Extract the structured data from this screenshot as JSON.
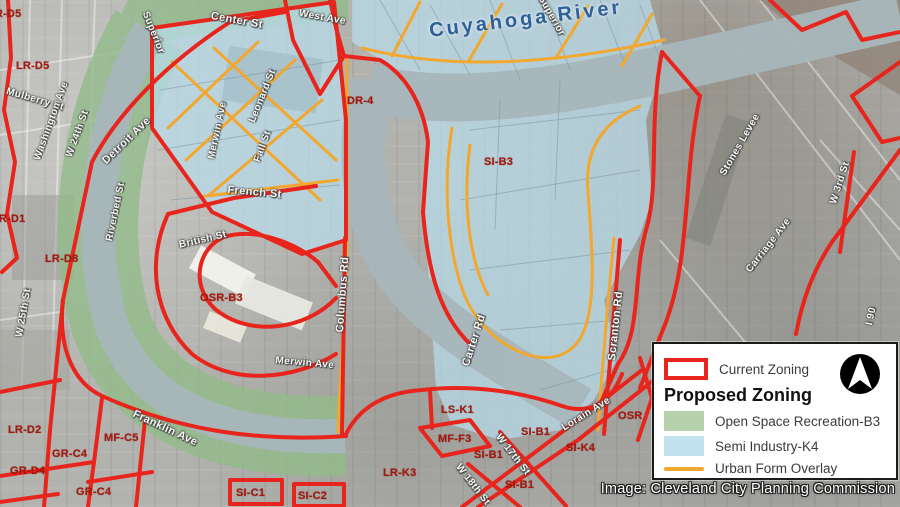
{
  "map": {
    "river_label": {
      "text": "Cuyahoga River"
    },
    "street_labels": [
      {
        "text": "Center St",
        "x": 212,
        "y": 10,
        "rot": 10,
        "size": 11
      },
      {
        "text": "Superior",
        "x": 150,
        "y": 10,
        "rot": 68
      },
      {
        "text": "Superior",
        "x": 545,
        "y": -6,
        "rot": 60
      },
      {
        "text": "Mulberry St",
        "x": 8,
        "y": 86,
        "rot": 16
      },
      {
        "text": "Washington Ave",
        "x": 32,
        "y": 158,
        "rot": -70
      },
      {
        "text": "W 24th St",
        "x": 64,
        "y": 155,
        "rot": -70
      },
      {
        "text": "Detroit Ave",
        "x": 100,
        "y": 158,
        "rot": -44,
        "size": 11
      },
      {
        "text": "Riverbed St",
        "x": 104,
        "y": 240,
        "rot": -78
      },
      {
        "text": "W 25th St",
        "x": 14,
        "y": 336,
        "rot": -80
      },
      {
        "text": "Leonard St",
        "x": 247,
        "y": 120,
        "rot": -68
      },
      {
        "text": "Merwin Ave",
        "x": 206,
        "y": 158,
        "rot": -78
      },
      {
        "text": "Fall St",
        "x": 252,
        "y": 160,
        "rot": -70
      },
      {
        "text": "West Ave",
        "x": 300,
        "y": 8,
        "rot": 10
      },
      {
        "text": "French St",
        "x": 228,
        "y": 184,
        "rot": 5,
        "size": 11
      },
      {
        "text": "British St",
        "x": 178,
        "y": 240,
        "rot": -13
      },
      {
        "text": "Columbus Rd",
        "x": 334,
        "y": 332,
        "rot": -86,
        "size": 11
      },
      {
        "text": "Merwin Ave",
        "x": 276,
        "y": 355,
        "rot": 5
      },
      {
        "text": "Franklin Ave",
        "x": 136,
        "y": 408,
        "rot": 25,
        "size": 11
      },
      {
        "text": "Carter Rd",
        "x": 460,
        "y": 364,
        "rot": -72,
        "size": 11
      },
      {
        "text": "Scranton Rd",
        "x": 606,
        "y": 360,
        "rot": -84,
        "size": 11
      },
      {
        "text": "Lorain Ave",
        "x": 560,
        "y": 424,
        "rot": -32
      },
      {
        "text": "Stones Levee",
        "x": 718,
        "y": 172,
        "rot": -60
      },
      {
        "text": "W 3rd St",
        "x": 828,
        "y": 202,
        "rot": -72
      },
      {
        "text": "Carriage Ave",
        "x": 744,
        "y": 268,
        "rot": -52
      },
      {
        "text": "W 17th St",
        "x": 502,
        "y": 432,
        "rot": 52
      },
      {
        "text": "W 18th St",
        "x": 462,
        "y": 462,
        "rot": 52
      },
      {
        "text": "I 90",
        "x": 864,
        "y": 324,
        "rot": -78
      }
    ],
    "zone_labels": [
      {
        "text": "LR-D5",
        "x": -12,
        "y": 8
      },
      {
        "text": "LR-D5",
        "x": 16,
        "y": 60
      },
      {
        "text": "LR-D1",
        "x": -8,
        "y": 213
      },
      {
        "text": "LR-D8",
        "x": 45,
        "y": 253
      },
      {
        "text": "DR-4",
        "x": 347,
        "y": 95
      },
      {
        "text": "SI-B3",
        "x": 484,
        "y": 156
      },
      {
        "text": "OSR-B3",
        "x": 200,
        "y": 292
      },
      {
        "text": "OSR",
        "x": 618,
        "y": 410
      },
      {
        "text": "LS-K1",
        "x": 441,
        "y": 404
      },
      {
        "text": "MF-F3",
        "x": 438,
        "y": 433
      },
      {
        "text": "SI-B1",
        "x": 521,
        "y": 426
      },
      {
        "text": "SI-B1",
        "x": 474,
        "y": 449
      },
      {
        "text": "SI-K4",
        "x": 566,
        "y": 442
      },
      {
        "text": "LR-K3",
        "x": 383,
        "y": 467
      },
      {
        "text": "SI-B1",
        "x": 505,
        "y": 479
      },
      {
        "text": "LR-D2",
        "x": 8,
        "y": 424
      },
      {
        "text": "MF-C5",
        "x": 104,
        "y": 432
      },
      {
        "text": "GR-C4",
        "x": 52,
        "y": 448
      },
      {
        "text": "GR-D4",
        "x": 10,
        "y": 465
      },
      {
        "text": "GR-C4",
        "x": 76,
        "y": 486
      },
      {
        "text": "SI-C1",
        "x": 236,
        "y": 487
      },
      {
        "text": "SI-C2",
        "x": 298,
        "y": 490
      }
    ]
  },
  "legend": {
    "current_label": "Current Zoning",
    "heading": "Proposed Zoning",
    "items": [
      {
        "label": "Open Space Recreation-B3",
        "swatch": "green"
      },
      {
        "label": "Semi Industry-K4",
        "swatch": "blue"
      },
      {
        "label": "Urban Form Overlay",
        "swatch": "orange-line"
      }
    ]
  },
  "attribution": {
    "text": "Image: Cleveland City Planning Commission"
  },
  "colors": {
    "current_zoning_red": "#e8251c",
    "open_space_green": "#92bb8a",
    "semi_industry_blue": "#b9ddeb",
    "urban_form_orange": "#f2a72e",
    "river_gray_blue": "#a8b6bb",
    "river_label_blue": "#2d5f99",
    "zone_label_red": "#a8170c"
  }
}
